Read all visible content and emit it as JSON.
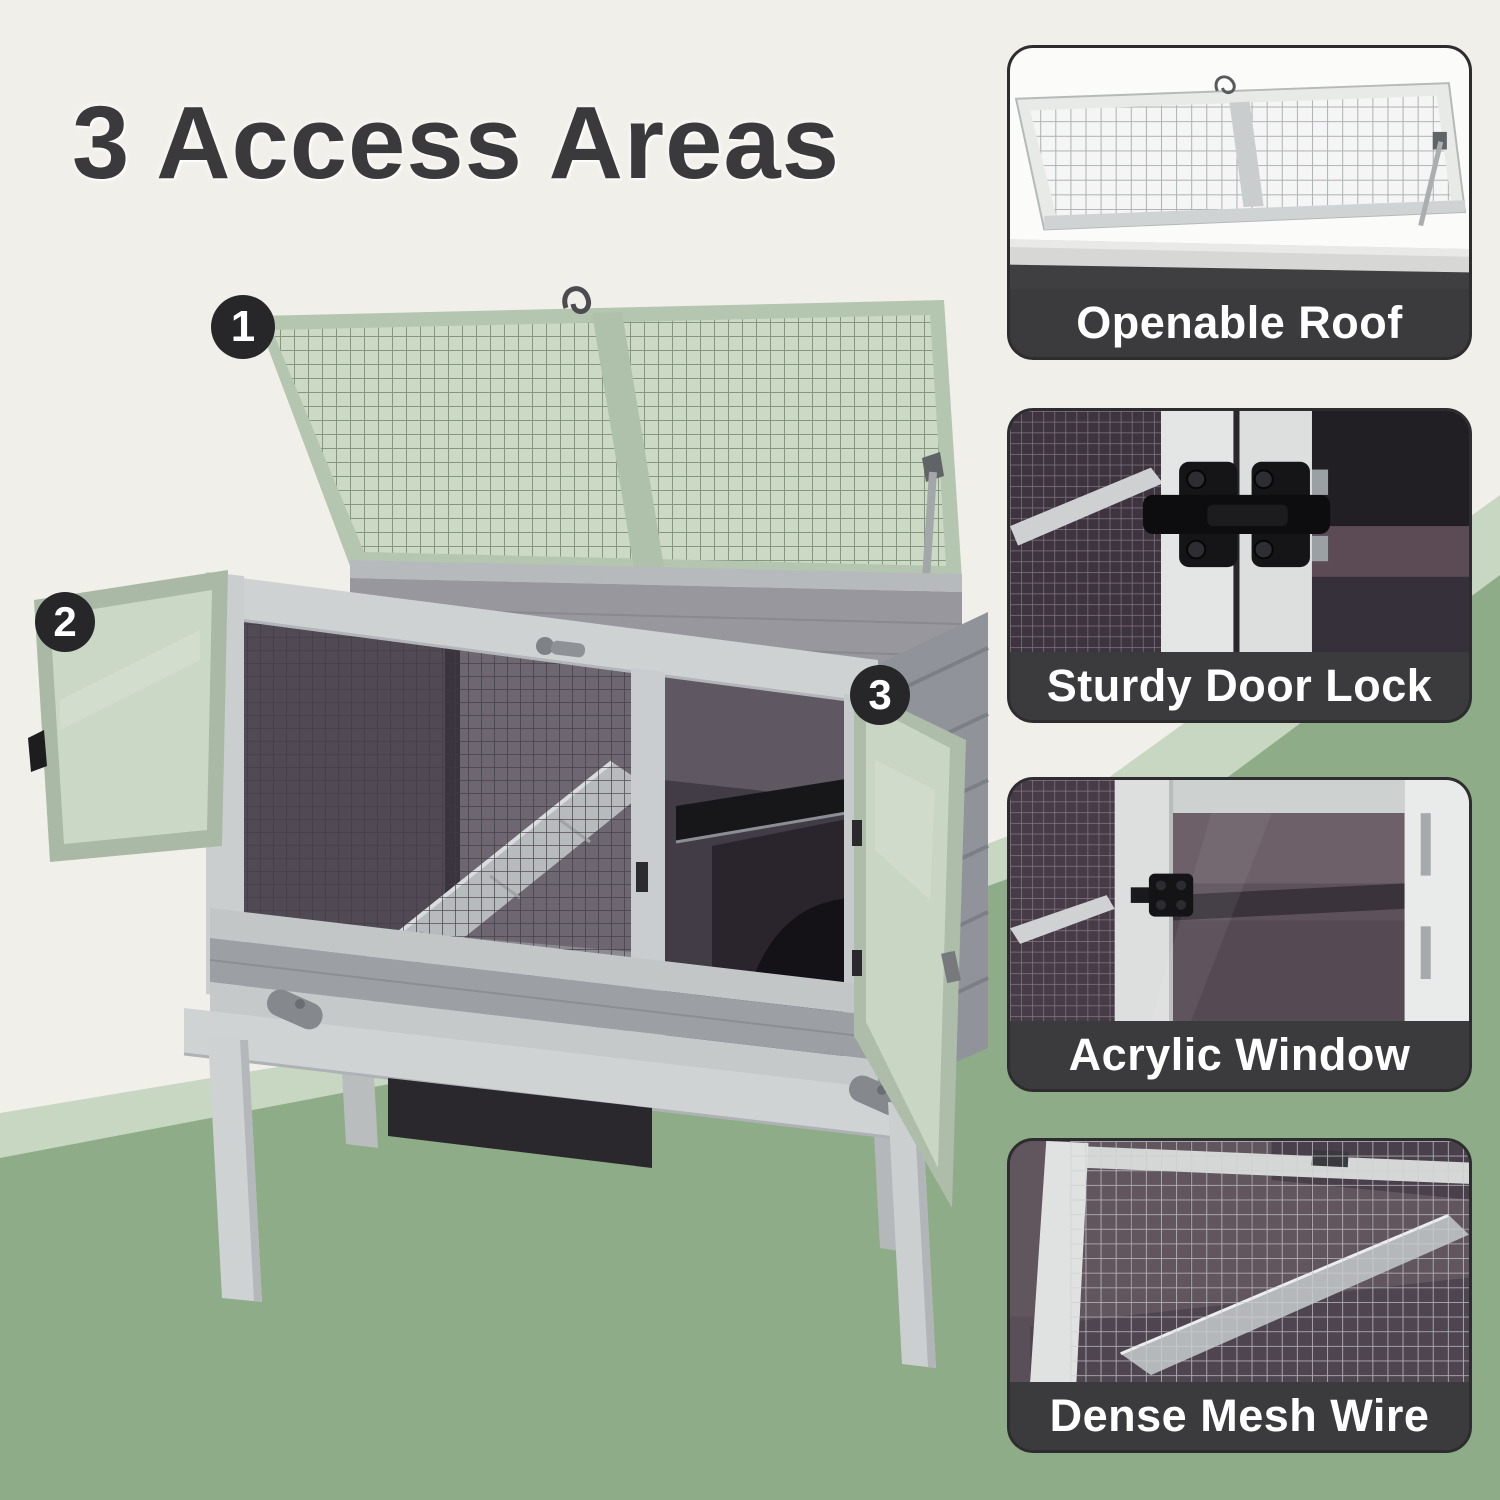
{
  "title": "3 Access Areas",
  "badges": [
    {
      "number": "1"
    },
    {
      "number": "2"
    },
    {
      "number": "3"
    }
  ],
  "feature_panels": [
    {
      "caption": "Openable Roof"
    },
    {
      "caption": "Sturdy Door Lock"
    },
    {
      "caption": "Acrylic Window"
    },
    {
      "caption": "Dense Mesh Wire"
    }
  ],
  "colors": {
    "bg": "#F1EFE9",
    "green-light": "#C8D7C1",
    "green": "#8FAC88",
    "title": "#3A393B",
    "badge-bg": "#27272A",
    "badge-text": "#FFFFFF",
    "caption-bg": "#3B3B3D",
    "caption-text": "#FFFFFF",
    "panel-border": "#2D2D2F",
    "wood-light": "#CDD1D2",
    "wood-mid": "#9CA0A4",
    "acrylic-green": "#CCD8C6",
    "interior-dark": "#423C46"
  }
}
